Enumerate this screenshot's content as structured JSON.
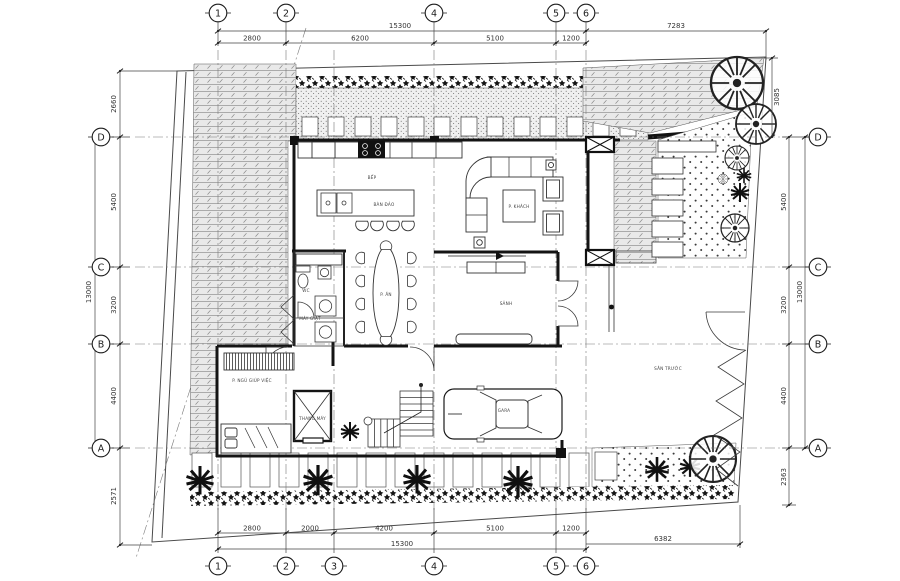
{
  "colors": {
    "paper": "#ffffff",
    "line": "#141414",
    "dim_line": "#444444",
    "hatch_gray": "#9b9b9b",
    "hatch_bg": "#e9e9e9"
  },
  "grid": {
    "top": [
      {
        "label": "1"
      },
      {
        "label": "2"
      },
      {
        "label": "4"
      },
      {
        "label": "5"
      },
      {
        "label": "6"
      }
    ],
    "bottom": [
      {
        "label": "1"
      },
      {
        "label": "2"
      },
      {
        "label": "3"
      },
      {
        "label": "4"
      },
      {
        "label": "5"
      },
      {
        "label": "6"
      }
    ],
    "left": [
      {
        "label": "D"
      },
      {
        "label": "C"
      },
      {
        "label": "B"
      },
      {
        "label": "A"
      }
    ],
    "right": [
      {
        "label": "D"
      },
      {
        "label": "C"
      },
      {
        "label": "B"
      },
      {
        "label": "A"
      }
    ]
  },
  "dims": {
    "top": {
      "total": "15300",
      "segments": [
        "2800",
        "6200",
        "5100",
        "1200"
      ],
      "side": "7283"
    },
    "bottom": {
      "total": "15300",
      "segments": [
        "2800",
        "2000",
        "4200",
        "5100",
        "1200"
      ],
      "side": "6382"
    },
    "left": {
      "above": "2660",
      "segments": [
        "5400",
        "3200",
        "4400"
      ],
      "total": "13000",
      "below": "2571"
    },
    "right": {
      "above": "3085",
      "segments": [
        "5400",
        "3200",
        "4400"
      ],
      "total": "13000",
      "below": "2363"
    }
  },
  "rooms": {
    "kitchen": "BẾP",
    "island": "BÀN ĐẢO",
    "dining": "P. ĂN",
    "living": "P. KHÁCH",
    "hall": "SẢNH",
    "wc": "WC",
    "laundry": "MÁY GIẶT",
    "maid": "P. NGỦ GIÚP VIỆC",
    "elevator": "THANG MÁY",
    "garage": "GARA",
    "front_yard": "SÂN TRƯỚC"
  }
}
